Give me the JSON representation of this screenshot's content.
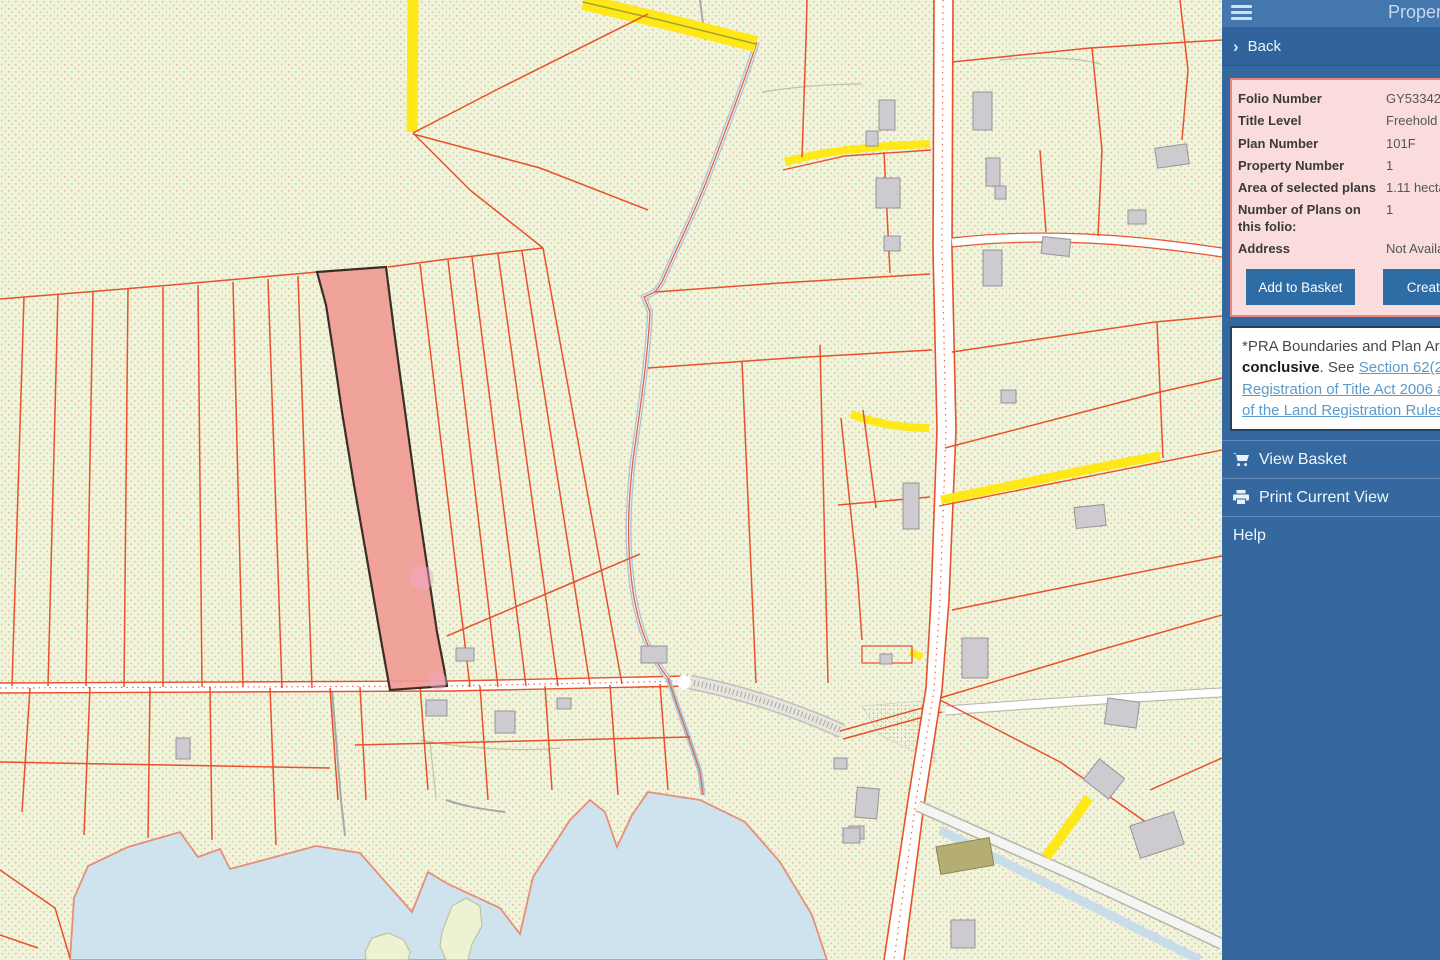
{
  "app": {
    "header_title": "Property",
    "hamburger_icon": "menu-icon"
  },
  "sidebar": {
    "back_label": "Back",
    "property_panel": {
      "rows": [
        {
          "label": "Folio Number",
          "value": "GY53342F"
        },
        {
          "label": "Title Level",
          "value": "Freehold"
        },
        {
          "label": "Plan Number",
          "value": "101F"
        },
        {
          "label": "Property Number",
          "value": "1"
        },
        {
          "label": "Area of selected plans",
          "value": "1.11 hectares"
        },
        {
          "label": "Number of Plans on this folio:",
          "value": "1"
        },
        {
          "label": "Address",
          "value": "Not Available"
        }
      ],
      "add_to_basket_label": "Add to Basket",
      "create_label": "Create"
    },
    "disclaimer": {
      "text_prefix": "*PRA Boundaries and Plan Area ",
      "text_bold": "are not conclusive",
      "text_mid": ". See ",
      "link_text": "Section 62(2) of Registration of Title Act 2006 and Rule 5 of the Land Registration Rules"
    },
    "menu": [
      {
        "label": "View Basket",
        "icon": "cart-icon"
      },
      {
        "label": "Print Current View",
        "icon": "printer-icon"
      },
      {
        "label": "Help",
        "icon": ""
      }
    ]
  },
  "map": {
    "selected_parcel": {
      "fill": "#f09a92",
      "outline": "#3a2e26"
    },
    "colors": {
      "background": "#f0f4da",
      "parcel_line": "#e8512b",
      "water": "#cfe3ef",
      "road_yellow": "#ffe817",
      "building": "#cdcad0",
      "sidebar_blue": "#34689f",
      "panel_pink": "#fbdcdc",
      "header_blue": "#4377ad",
      "button_blue": "#2d6ca5"
    }
  }
}
